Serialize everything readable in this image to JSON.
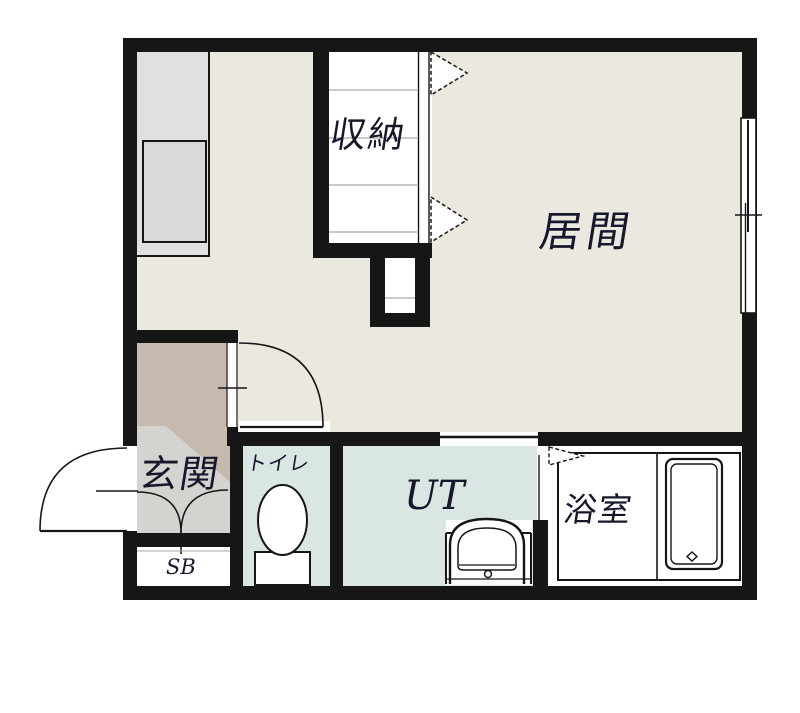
{
  "title": "apartment-floor-plan",
  "rooms": {
    "living": "居間",
    "closet": "収納",
    "entrance": "玄関",
    "shoe_box": "SB",
    "toilet": "トイレ",
    "utility": "UT",
    "bathroom": "浴室"
  },
  "colors": {
    "wall": "#161616",
    "living_floor": "#ebe8e0",
    "hall_floor": "#c6baae",
    "tataki_floor": "#d5d3d0",
    "wet_floor": "#d9e6e2",
    "counter_gray": "#e1e0e0",
    "unit_gray": "#d9d9d9",
    "shelf_line": "#a9a9a9",
    "text": "#17172b"
  },
  "icons": [
    "sliding-window-icon",
    "door-swing-icon",
    "bifold-door-arrow-icon",
    "folding-door-icon",
    "toilet-icon",
    "washbasin-icon",
    "bathtub-icon",
    "shoe-box-doors-icon"
  ]
}
